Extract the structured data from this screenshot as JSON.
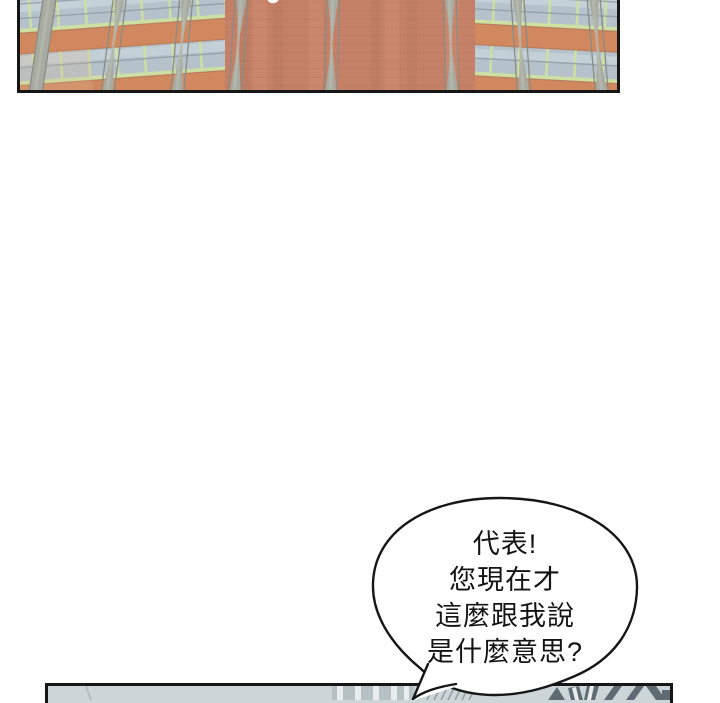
{
  "page": {
    "background": "#ffffff"
  },
  "top_panel": {
    "description": "upward view of a brick-and-glass building facade",
    "border_color": "#161616",
    "building": {
      "glass_color": "#b5c2cc",
      "glass_light": "#c8d3d9",
      "mullion_green": "#cde0a2",
      "frame_gray": "#93a0a8",
      "spandrel_orange": "#d2885e",
      "brick_color": "#c58168",
      "pillar_gray": "#a8aba1",
      "speck_color": "#ffffff"
    }
  },
  "speech_bubble": {
    "fill": "#ffffff",
    "stroke": "#161616",
    "lines": [
      "代表!",
      "您現在才",
      "這麼跟我說",
      "是什麼意思?"
    ]
  },
  "bottom_panel": {
    "border_color": "#161616",
    "fill": "#ccd6d9",
    "stripe_color": "#e9edee",
    "stripe_bg": "#b6c1c4",
    "hatch_color": "#95a1a6",
    "dark_shape_color": "#5f6b72"
  }
}
